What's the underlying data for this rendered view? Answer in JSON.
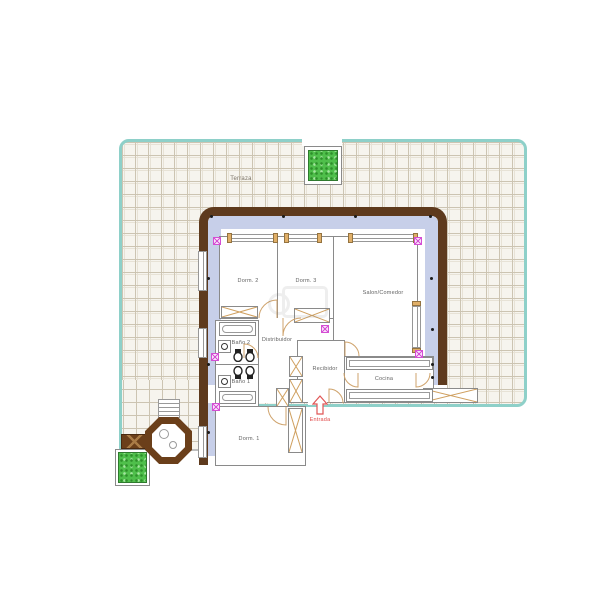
{
  "plan": {
    "terrace_label": "Terraza",
    "entrance_label": "Entrada",
    "rooms": [
      {
        "id": "dorm2",
        "label": "Dorm. 2"
      },
      {
        "id": "dorm3",
        "label": "Dorm. 3"
      },
      {
        "id": "salon",
        "label": "Salon/Comedor"
      },
      {
        "id": "distribuidor",
        "label": "Distribuidor"
      },
      {
        "id": "banio2",
        "label": "Baño 2"
      },
      {
        "id": "banio1",
        "label": "Baño 1"
      },
      {
        "id": "recibidor",
        "label": "Recibidor"
      },
      {
        "id": "cocina",
        "label": "Cocina"
      },
      {
        "id": "dorm1",
        "label": "Dorm. 1"
      }
    ],
    "outdoor_elements": [
      "terrace-tiles",
      "planter-top",
      "planter-bottom-left",
      "hot-tub",
      "stairs",
      "bench",
      "terrace-cabinet"
    ],
    "colors": {
      "wall_brown": "#5e3a1d",
      "cavity_blue": "#c7cfe9",
      "terrace_teal": "#8ed0c9",
      "tile_line": "#ccc4b2",
      "wood_tan": "#e0af68",
      "symbol_magenta": "#d44fd4",
      "entrance_red": "#e04848",
      "plant_green": "#4fbf4b",
      "room_line_gray": "#8a8a8a"
    }
  }
}
